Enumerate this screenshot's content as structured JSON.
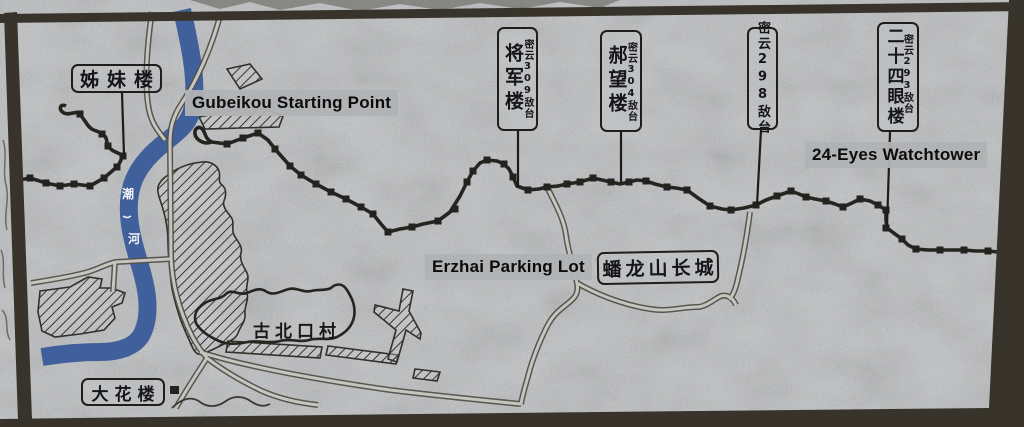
{
  "sign": {
    "english_overlays": {
      "gubeikou_start": "Gubeikou Starting Point",
      "erzhai_parking": "Erzhai Parking Lot",
      "watchtower_24_eyes": "24-Eyes Watchtower"
    },
    "boxed_labels": {
      "zimei_tower": "姊妹楼",
      "dahua_tower": "大花楼",
      "panlongshan_wall": "蟠龙山长城"
    },
    "tower_labels": [
      {
        "name": "将军楼",
        "subtitle": "密云309敌台"
      },
      {
        "name": "郝望楼",
        "subtitle": "密云304敌台"
      },
      {
        "name": "密云298敌台",
        "subtitle": ""
      },
      {
        "name": "二十四眼楼",
        "subtitle": "密云293敌台"
      }
    ],
    "place_labels": {
      "gubeikou_village": "古北口村"
    },
    "river": {
      "name_chars": [
        "潮",
        "河"
      ]
    },
    "colors": {
      "river_blue": "#41619e",
      "ink": "#2a2824",
      "overlay_band": "#b0b2b4",
      "stone": "#c8cacc",
      "frame": "#38342b"
    }
  }
}
